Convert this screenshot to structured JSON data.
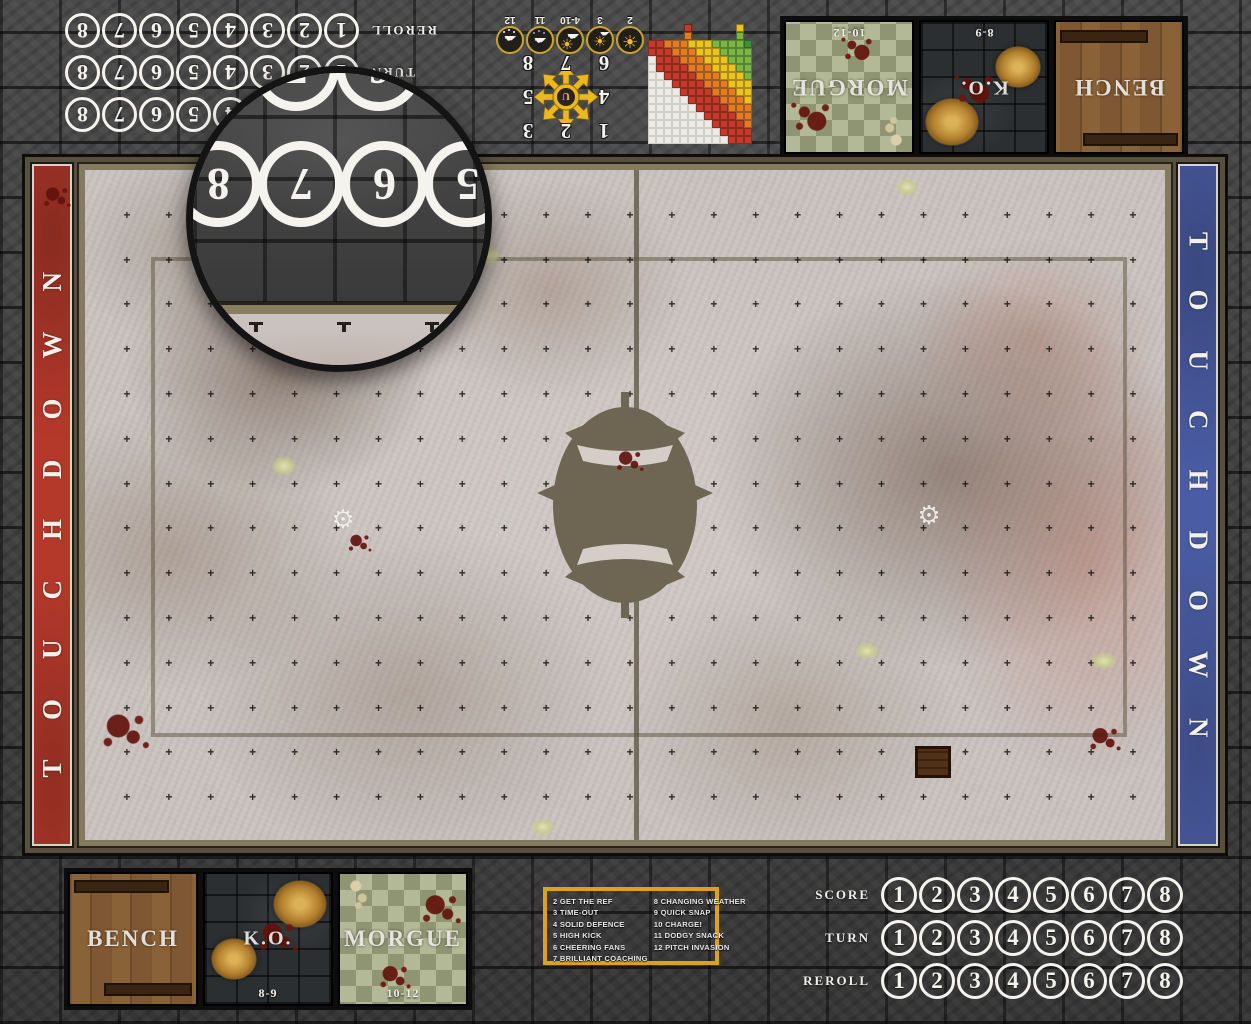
{
  "mat": {
    "type": "dungeon-fantasy-football-game-mat",
    "frame_color": "#3f3f3f",
    "pitch_frame_color": "#57503f",
    "field_color": "#c9c2be"
  },
  "touchdown": {
    "text": "TOUCHDOWN",
    "left_color": "#b5392b",
    "right_color": "#4a5ca3"
  },
  "trackers": {
    "rows": [
      {
        "label": "SCORE"
      },
      {
        "label": "TURN"
      },
      {
        "label": "REROLL"
      }
    ],
    "numbers": [
      "1",
      "2",
      "3",
      "4",
      "5",
      "6",
      "7",
      "8"
    ]
  },
  "dugout": {
    "bench_label": "BENCH",
    "ko_label": "K.O.",
    "ko_range": "8-9",
    "morgue_label": "MORGUE",
    "morgue_range": "10-12"
  },
  "kickoff": {
    "left": [
      "2 GET THE REF",
      "3 TIME-OUT",
      "4 SOLID DEFENCE",
      "5 HIGH KICK",
      "6 CHEERING FANS",
      "7 BRILLIANT COACHING"
    ],
    "right": [
      "8 CHANGING WEATHER",
      "9 QUICK SNAP",
      "10 CHARGE!",
      "11 DODGY SNACK",
      "12 PITCH INVASION"
    ],
    "border_color": "#dda21c"
  },
  "weather": {
    "items": [
      {
        "value": "2",
        "icon": "sun-icon"
      },
      {
        "value": "3",
        "icon": "sun-small-cloud-icon"
      },
      {
        "value": "4-10",
        "icon": "cloud-sun-icon"
      },
      {
        "value": "11",
        "icon": "rain-cloud-icon"
      },
      {
        "value": "12",
        "icon": "blizzard-cloud-icon"
      }
    ]
  },
  "scatter": {
    "grid": [
      [
        "1",
        "2",
        "3"
      ],
      [
        "4",
        "",
        "5"
      ],
      [
        "6",
        "7",
        "8"
      ]
    ],
    "hub": "U",
    "arrow_color": "#ecb71f"
  },
  "range_chart": {
    "cols": 13,
    "rows": 13,
    "colors": {
      "red": "#c23b2a",
      "orange": "#e07b26",
      "yellow": "#ecc322",
      "green": "#79b643",
      "dark_green": "#3f8f3d",
      "empty": "#eeece6"
    },
    "legend_colors": [
      "#c23b2a",
      "#e07b26",
      "#ecc322",
      "#79b643"
    ],
    "bands": {
      "green_min": 8,
      "yellow_min": 5,
      "orange_min": 2
    }
  },
  "field_grid": {
    "cols": 26,
    "rows": 15,
    "mark": "+"
  },
  "magnifier": {
    "row_partial": [
      "",
      "7",
      "6",
      ""
    ],
    "row_main": [
      "8",
      "7",
      "6",
      "5"
    ]
  },
  "watermark": {
    "icon": "gear-icon",
    "glyph": "⚙"
  }
}
